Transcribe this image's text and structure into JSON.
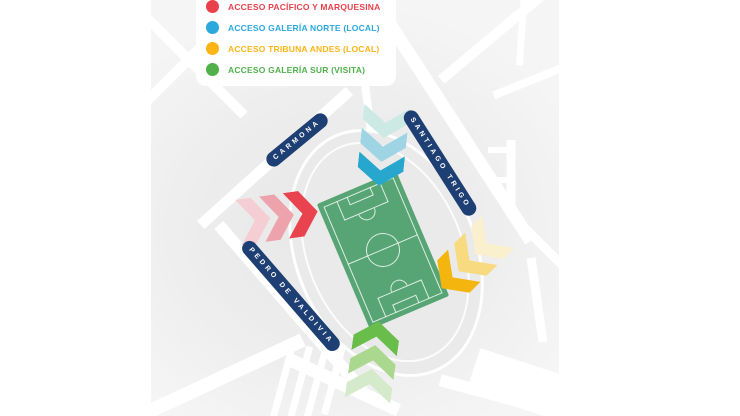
{
  "legend": {
    "items": [
      {
        "label": "ACCESO PACÍFICO Y MARQUESINA",
        "color": "#e8414c"
      },
      {
        "label": "ACCESO GALERÍA NORTE (LOCAL)",
        "color": "#29a9dc"
      },
      {
        "label": "ACCESO TRIBUNA ANDES (LOCAL)",
        "color": "#fdb515"
      },
      {
        "label": "ACCESO GALERÍA SUR (VISITA)",
        "color": "#50b14b"
      }
    ]
  },
  "streets": {
    "pill_color": "#1e3f73",
    "labels": [
      {
        "name": "CARMONA"
      },
      {
        "name": "SANTIAGO TRIGO"
      },
      {
        "name": "PEDRO DE VALDIVIA"
      }
    ]
  },
  "stadium": {
    "pitch_color": "#57a575"
  },
  "arrows": {
    "north": {
      "access": "galeria-norte",
      "direction": "down",
      "colors": [
        "#27a7ce",
        "#9ed4e4",
        "#cde9e3"
      ]
    },
    "west": {
      "access": "pacifico",
      "direction": "right",
      "colors": [
        "#e8434f",
        "#eda3ab",
        "#f4ced2"
      ]
    },
    "east": {
      "access": "tribuna-andes",
      "direction": "down-left",
      "colors": [
        "#f5b50f",
        "#f8da80",
        "#faf0cd"
      ]
    },
    "south": {
      "access": "galeria-sur",
      "direction": "up",
      "colors": [
        "#69bd4b",
        "#aad88f",
        "#d5eacb"
      ]
    }
  },
  "colors": {
    "map_background": "#ececec",
    "street_color": "#ffffff",
    "page_background": "#ffffff"
  }
}
